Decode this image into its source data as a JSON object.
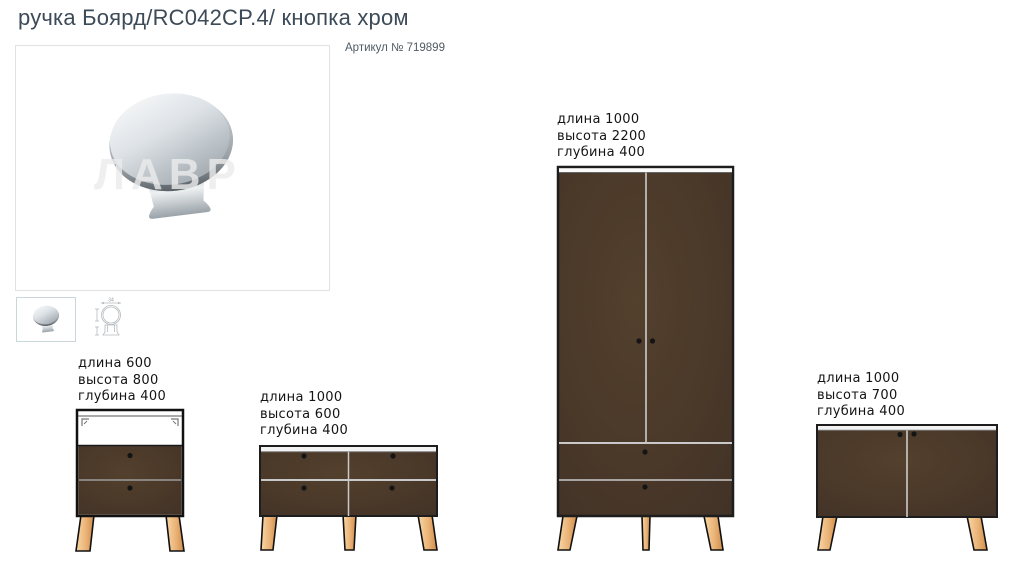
{
  "header": {
    "title": "ручка Боярд/RC042CP.4/ кнопка хром",
    "sku": "Артикул № 719899"
  },
  "gallery": {
    "watermark": "ЛАВР",
    "thumb_dim_label": "34"
  },
  "colors": {
    "furniture_brown": "#4a3829",
    "leg_wood": "#eab377",
    "chrome_light": "#f4f6f7",
    "chrome_dark": "#8e969c",
    "title_text": "#3d4a57"
  },
  "furniture": [
    {
      "specs": {
        "length": "длина 600",
        "height": "высота 800",
        "depth": "глубина 400"
      }
    },
    {
      "specs": {
        "length": "длина 1000",
        "height": "высота 600",
        "depth": "глубина 400"
      }
    },
    {
      "specs": {
        "length": "длина 1000",
        "height": "высота 2200",
        "depth": "глубина 400"
      }
    },
    {
      "specs": {
        "length": "длина 1000",
        "height": "высота 700",
        "depth": "глубина 400"
      }
    }
  ]
}
